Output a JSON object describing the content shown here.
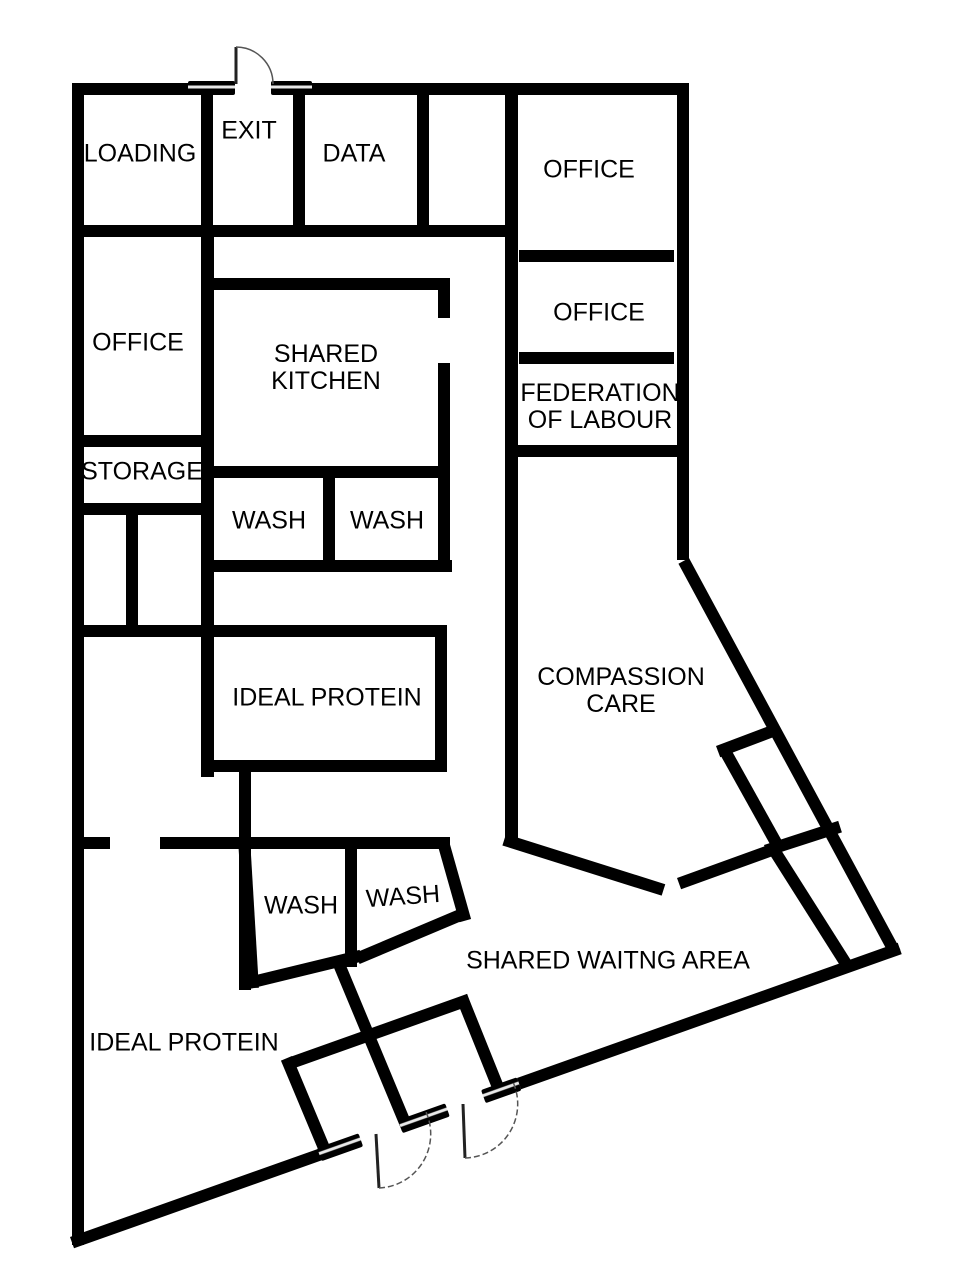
{
  "rooms": {
    "loading": "LOADING",
    "exit": "EXIT",
    "data": "DATA",
    "office_top_right": "OFFICE",
    "office_right_2": "OFFICE",
    "federation": "FEDERATION OF LABOUR",
    "office_left": "OFFICE",
    "storage": "STORAGE",
    "shared_kitchen": "SHARED KITCHEN",
    "wash_upper_left": "WASH",
    "wash_upper_right": "WASH",
    "ideal_protein_room": "IDEAL PROTEIN",
    "compassion_care": "COMPASSION CARE",
    "wash_lower_left": "WASH",
    "wash_lower_right": "WASH",
    "shared_waiting": "SHARED WAITNG AREA",
    "ideal_protein_area": "IDEAL PROTEIN"
  },
  "colors": {
    "wall": "#000000",
    "background": "#ffffff",
    "door_arc": "#555555"
  }
}
